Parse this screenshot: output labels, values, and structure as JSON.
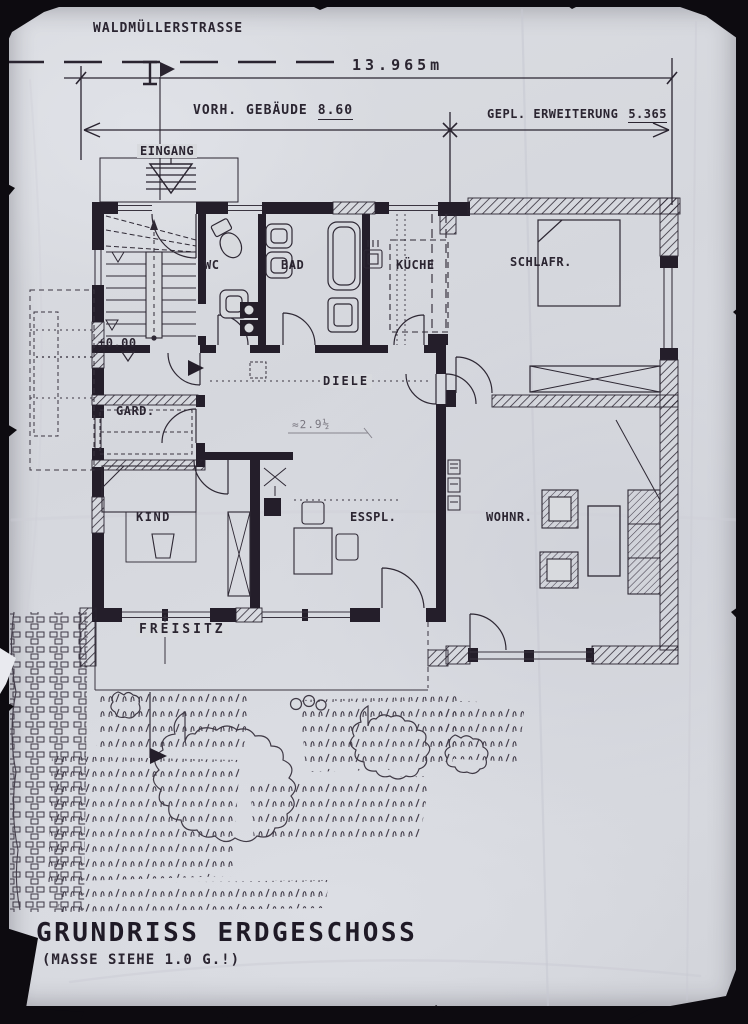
{
  "meta": {
    "title": "GRUNDRISS ERDGESCHOSS",
    "subtitle": "(MASSE SIEHE 1.0 G.!)"
  },
  "street": {
    "label": "WALDMÜLLERSTRASSE"
  },
  "dimensions": {
    "total_length": "13.965m",
    "existing_label": "VORH. GEBÄUDE",
    "existing_value": "8.60",
    "extension_label": "GEPL. ERWEITERUNG",
    "extension_value": "5.365"
  },
  "annotations": {
    "entrance_label": "EINGANG",
    "floor_level": "±0.00",
    "handwritten_dim": "≈2.9½"
  },
  "rooms": {
    "wc": "WC",
    "bad": "BAD",
    "kueche": "KÜCHE",
    "schlafzimmer": "SCHLAFR.",
    "diele": "DIELE",
    "garderobe": "GARD.",
    "kind": "KIND",
    "essplatz": "ESSPL.",
    "wohnzimmer": "WOHNR.",
    "freisitz": "FREISITZ"
  },
  "colors": {
    "paper": "#d8dade",
    "ink": "#2a2430",
    "ink_soft": "#3a3440"
  }
}
